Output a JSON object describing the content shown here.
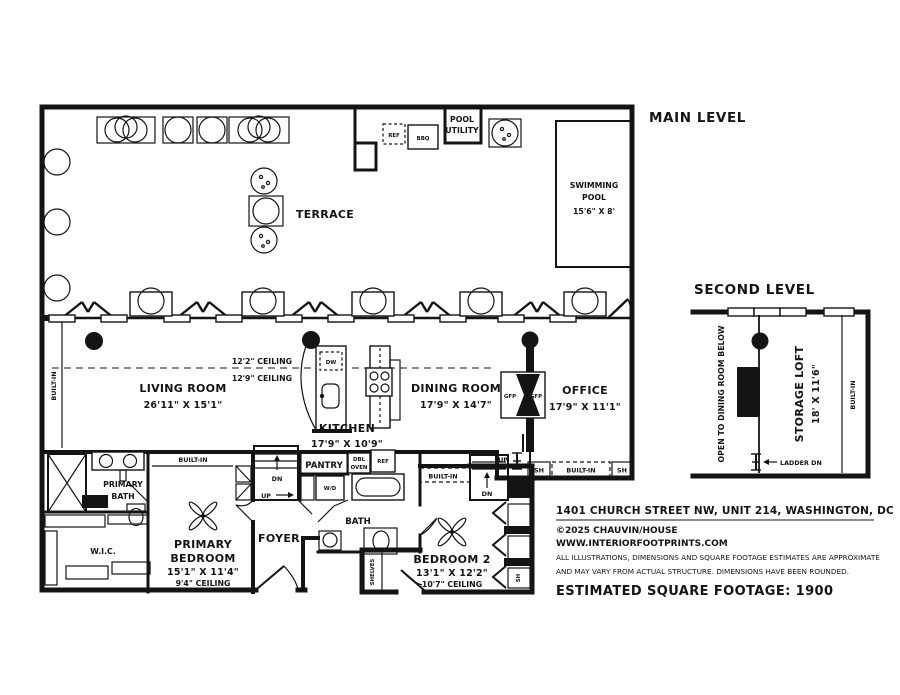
{
  "levels": {
    "main": "MAIN LEVEL",
    "second": "SECOND LEVEL"
  },
  "terrace": {
    "label": "TERRACE"
  },
  "pool_utility": {
    "l1": "POOL",
    "l2": "UTILITY"
  },
  "pool": {
    "l1": "SWIMMING",
    "l2": "POOL",
    "dims": "15'6\" X 8'"
  },
  "living": {
    "name": "LIVING ROOM",
    "dims": "26'11\" X 15'1\""
  },
  "kitchen": {
    "name": "KITCHEN",
    "dims": "17'9\" X 10'9\""
  },
  "dining": {
    "name": "DINING ROOM",
    "dims": "17'9\" X 14'7\""
  },
  "office": {
    "name": "OFFICE",
    "dims": "17'9\" X 11'1\""
  },
  "ceilings": {
    "upper": "12'2\" CEILING",
    "lower": "12'9\" CEILING"
  },
  "primary_bath": {
    "l1": "PRIMARY",
    "l2": "BATH"
  },
  "wic": {
    "name": "W.I.C."
  },
  "primary_bedroom": {
    "l1": "PRIMARY",
    "l2": "BEDROOM",
    "dims": "15'1\" X 11'4\"",
    "ceiling": "9'4\" CEILING"
  },
  "foyer": {
    "name": "FOYER"
  },
  "bath2": {
    "name": "BATH"
  },
  "bedroom2": {
    "name": "BEDROOM 2",
    "dims": "13'1\" X 12'2\"",
    "ceiling": "10'7\" CEILING"
  },
  "loft": {
    "open_below": "OPEN TO DINING ROOM BELOW",
    "name": "STORAGE LOFT",
    "dims": "18' X 11'6\"",
    "ladder": "LADDER DN"
  },
  "fixtures": {
    "ref": "REF",
    "bbq": "BBQ",
    "dw": "DW",
    "dbl": "DBL",
    "oven": "OVEN",
    "wd": "W/D",
    "gfp": "GFP",
    "pantry": "PANTRY",
    "shelves": "SHELVES",
    "built_in": "BUILT-IN",
    "sh": "SH",
    "up": "UP",
    "dn": "DN"
  },
  "footer": {
    "address": "1401 CHURCH STREET NW, UNIT 214, WASHINGTON, DC",
    "copyright": "©2025 CHAUVIN/HOUSE",
    "website": "WWW.INTERIORFOOTPRINTS.COM",
    "disclaimer1": "ALL ILLUSTRATIONS, DIMENSIONS AND SQUARE FOOTAGE ESTIMATES ARE APPROXIMATE",
    "disclaimer2": "AND MAY VARY FROM ACTUAL STRUCTURE. DIMENSIONS HAVE BEEN ROUNDED.",
    "sqft": "ESTIMATED SQUARE FOOTAGE: 1900"
  }
}
